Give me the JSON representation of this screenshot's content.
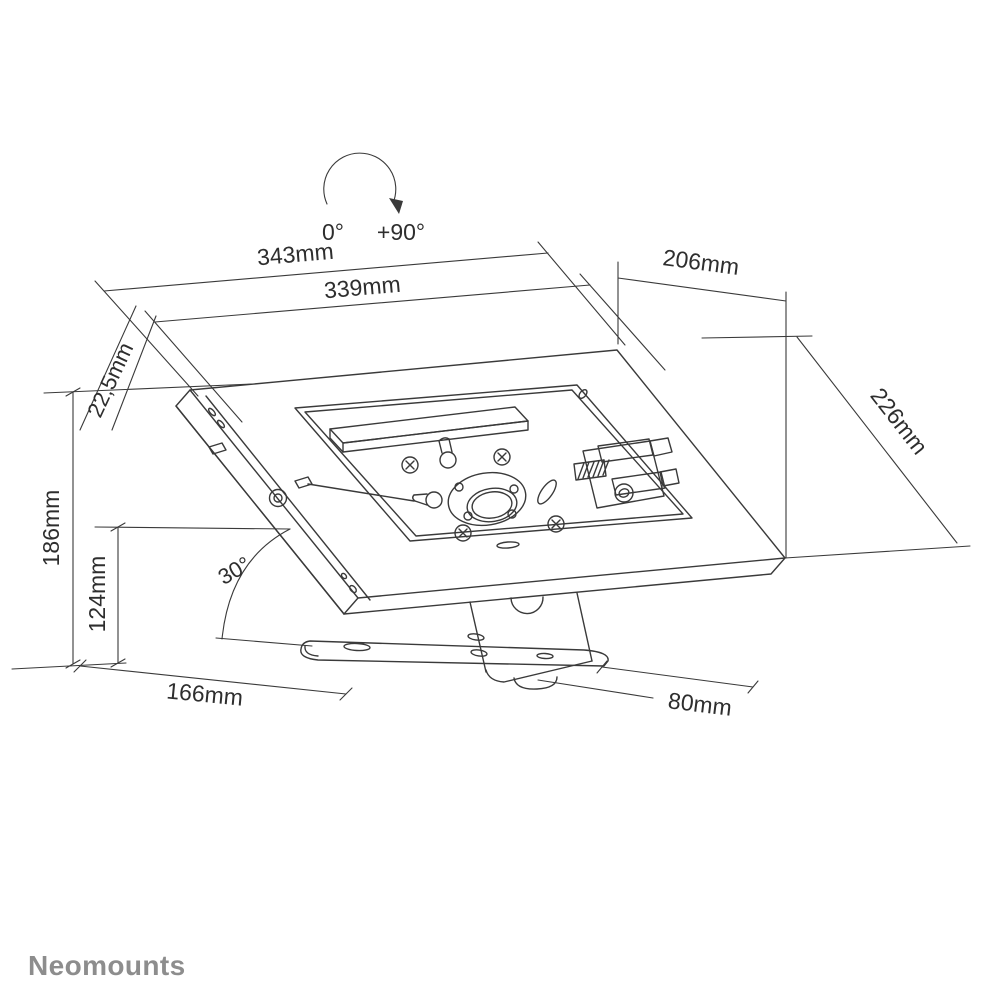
{
  "drawing": {
    "brand_logo": "Neomounts",
    "rotation_indicator": {
      "start": "0°",
      "end": "+90°"
    },
    "dimensions": {
      "outer_width": "343mm",
      "inner_width": "339mm",
      "top_depth": "206mm",
      "enclosure_thickness": "22,5mm",
      "surface_depth": "226mm",
      "total_height": "186mm",
      "pivot_height": "124mm",
      "tilt_angle": "30°",
      "base_depth": "166mm",
      "base_width": "80mm"
    },
    "colors": {
      "line": "#3a3a3a",
      "logo_gray": "#8d8d8d",
      "background": "#ffffff"
    }
  }
}
